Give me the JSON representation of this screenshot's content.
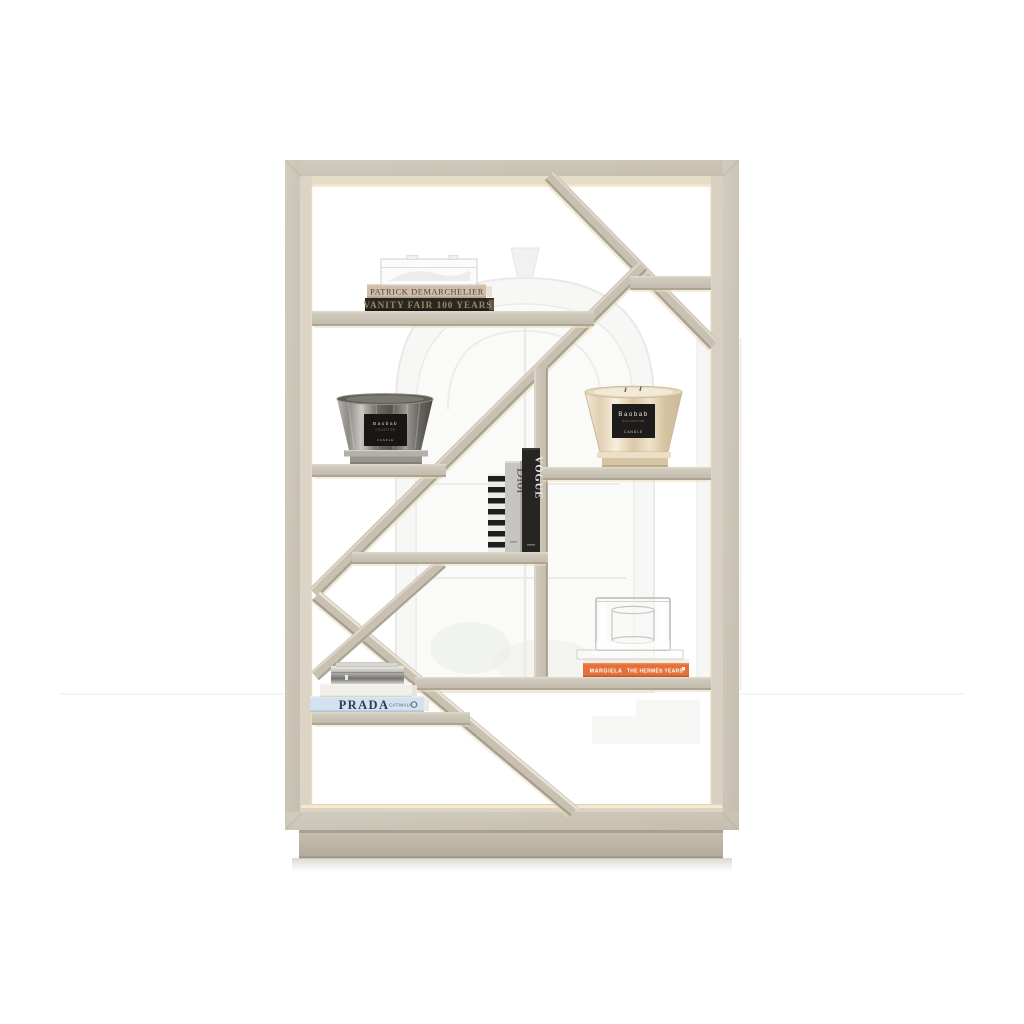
{
  "scene": {
    "description": "Product render of a light-oak geometric open display bookcase with LED-lit inner frame on a plinth base, styled with coffee-table books, Baobab Collection candles and glass objects, in front of a white wall with a faint arched window",
    "background_color": "#ffffff",
    "wood_color": "#cbc4b5",
    "wood_edge_dark": "#a59d8e",
    "wood_edge_light": "#ded8cb",
    "led_glow_color": "#f6ead0",
    "plinth_color": "#c0b8a9"
  },
  "items": {
    "demarchelier_book": {
      "title": "PATRICK DEMARCHELIER",
      "cover_color": "#d0bcaa",
      "text_color": "#4f4237"
    },
    "vanity_fair_book": {
      "title": "VANITY FAIR 100 YEARS",
      "cover_color": "#2a2723",
      "text_color": "#9b8660"
    },
    "acrylic_box": {
      "name": "clear acrylic keepsake box"
    },
    "gray_candle": {
      "brand": "Baobab",
      "collection": "COLLECTION",
      "type": "CANDLE",
      "glass_color": "#6e6a64"
    },
    "beige_candle": {
      "brand": "Baobab",
      "collection": "COLLECTION",
      "type": "CANDLE",
      "glass_color": "#e2d0b0"
    },
    "striped_book": {
      "name": "black and white striped book"
    },
    "dior_book": {
      "title": "Dior",
      "spine_color": "#c6c5c2"
    },
    "vogue_book": {
      "title": "VOGUE",
      "spine_color": "#262524"
    },
    "glass_cube": {
      "name": "square glass hurricane on glass slab"
    },
    "margiela_book": {
      "brand": "MARGIELA",
      "subtitle": "THE HERMÈS YEARS",
      "spine_color": "#e4703a"
    },
    "white_book": {
      "name": "white coffee-table book"
    },
    "metal_box": {
      "name": "polished metal box"
    },
    "prada_book": {
      "title": "PRADA",
      "subtitle": "CATWALK",
      "cover_color": "#d3e2ee"
    }
  }
}
